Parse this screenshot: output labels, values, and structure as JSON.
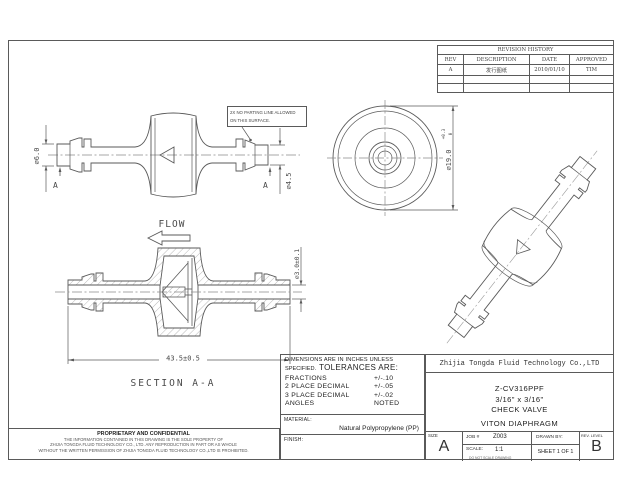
{
  "sheet": {
    "colors": {
      "ink": "#333333",
      "line": "#5a5a5a"
    },
    "revision_table": {
      "title": "REVISION HISTORY",
      "headers": [
        "REV",
        "DESCRIPTION",
        "DATE",
        "APPROVED"
      ],
      "row": {
        "rev": "A",
        "description": "发行图纸",
        "date": "2010/01/10",
        "approved": "TIM"
      }
    },
    "views": {
      "side": {
        "dim_tip_left": "⌀6.0",
        "dim_tip_right": "⌀4.5",
        "section_mark": "A",
        "note_line1": "2X NO PARTING LINE ALLOWED",
        "note_line2": "ON THIS SURFACE."
      },
      "front": {
        "dim_body": "⌀19.0",
        "tol_upper": "+0.3",
        "tol_lower": "0"
      },
      "section": {
        "flow": "FLOW",
        "label": "SECTION A-A",
        "dim_length": "43.5±0.5",
        "dim_bore": "⌀3.0±0.1"
      }
    },
    "tolerance_block": {
      "heading_line1": "DIMENSIONS ARE IN INCHES UNLESS",
      "heading_line2_small": "SPECIFIED.",
      "heading_line2_large": "TOLERANCES ARE:",
      "rows": [
        {
          "label": "FRACTIONS",
          "value": "+/-.10"
        },
        {
          "label": "2 PLACE DECIMAL",
          "value": "+/-.05"
        },
        {
          "label": "3 PLACE DECIMAL",
          "value": "+/-.02"
        },
        {
          "label": "ANGLES",
          "value": "NOTED"
        }
      ],
      "material_label": "MATERIAL:",
      "material_value": "Natural Polypropylene (PP)",
      "finish_label": "FINISH:"
    },
    "title_block": {
      "company": "Zhijia Tongda Fluid Technology Co.,LTD",
      "part_number": "Z-CV316PPF",
      "size_spec": "3/16\" x 3/16\"",
      "part_name": "CHECK VALVE",
      "diaphragm": "VITON DIAPHRAGM",
      "size_label": "SIZE",
      "size_value": "A",
      "job_label": "JOB #",
      "job_value": "Z003",
      "drawn_label": "DRAWN BY:",
      "scale_label": "SCALE:",
      "scale_value": "1:1",
      "scale_note": "DO NOT SCALE DRAWING",
      "sheet_text": "SHEET  1 OF 1",
      "rev_label": "REV. LEVEL",
      "rev_value": "B"
    },
    "proprietary": {
      "title": "PROPRIETARY AND CONFIDENTIAL",
      "line1": "THE INFORMATION CONTAINED IN THIS DRAWING IS THE SOLE PROPERTY OF",
      "line2": "ZHIJIA TONGDA FLUID TECHNOLOGY CO., LTD. ANY REPRODUCTION IN PART OR AS WHOLE",
      "line3": "WITHOUT THE WRITTEN PERMISSION OF  ZHIJIA TONGDA FLUID TECHNOLOGY CO.,LTD IS PROHIBITED."
    }
  }
}
